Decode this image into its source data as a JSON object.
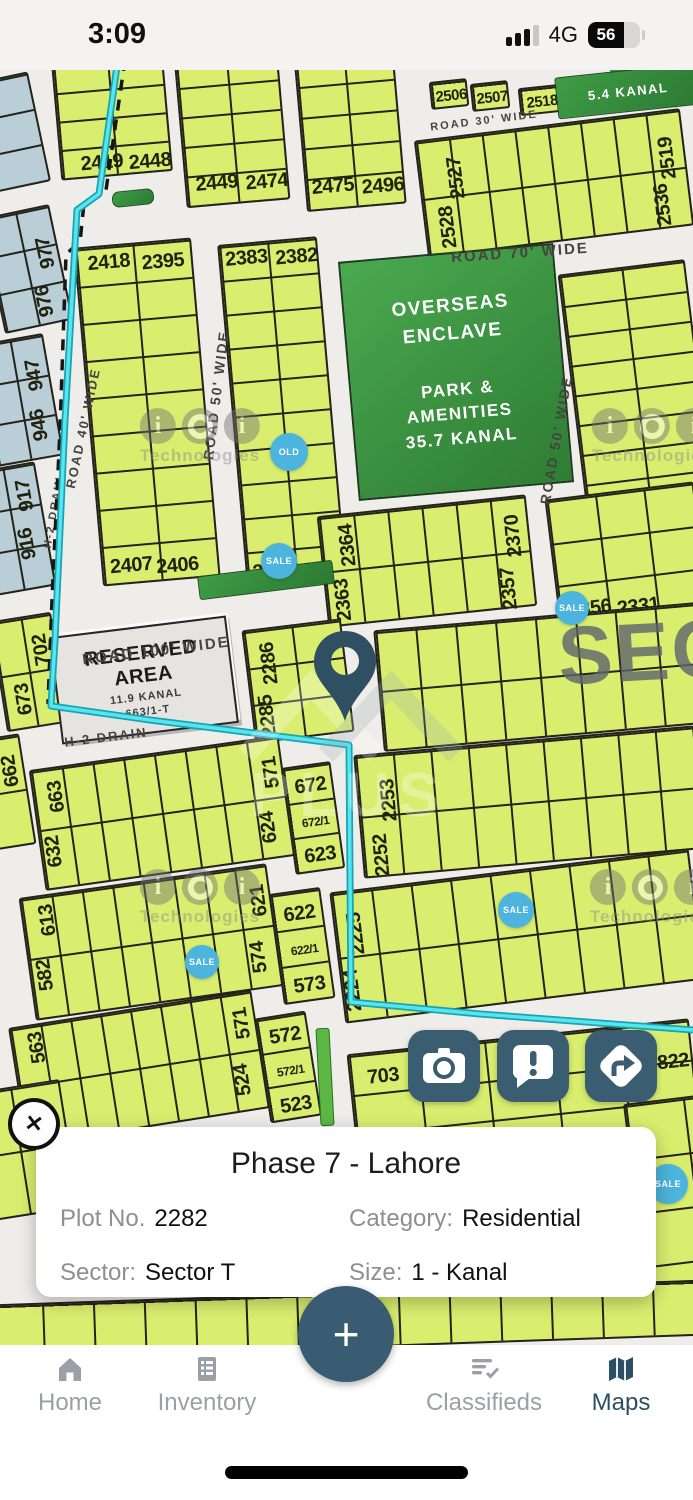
{
  "status_bar": {
    "time": "3:09",
    "network": "4G",
    "battery_percent": "56"
  },
  "map": {
    "colors": {
      "plot_fill": "#d9ee6f",
      "plot_border": "#23231a",
      "blue_plot": "#b9ced6",
      "park_green": "#3d9c43",
      "drain_cyan": "#4fdde7",
      "badge_blue": "#4cb4dd",
      "slate_accent": "#3b5d72"
    },
    "blocks": [
      {
        "x": -16,
        "y": 76,
        "w": 56,
        "h": 112,
        "cols": 1,
        "rows": 3,
        "rot": -12,
        "c": "blue",
        "labels": []
      },
      {
        "x": -8,
        "y": 210,
        "w": 70,
        "h": 118,
        "cols": 2,
        "rows": 3,
        "rot": -12,
        "c": "blue",
        "labels": [
          {
            "t": "977",
            "x": 55,
            "y": 45,
            "v": 1
          },
          {
            "t": "976",
            "x": 44,
            "y": 92,
            "v": 1
          }
        ]
      },
      {
        "x": -14,
        "y": 338,
        "w": 68,
        "h": 124,
        "cols": 2,
        "rows": 3,
        "rot": -10,
        "c": "blue",
        "labels": [
          {
            "t": "947",
            "x": 51,
            "y": 38,
            "v": 1
          },
          {
            "t": "946",
            "x": 47,
            "y": 88,
            "v": 1
          }
        ]
      },
      {
        "x": -20,
        "y": 466,
        "w": 66,
        "h": 126,
        "cols": 2,
        "rows": 3,
        "rot": -10,
        "c": "blue",
        "labels": [
          {
            "t": "917",
            "x": 49,
            "y": 30,
            "v": 1
          },
          {
            "t": "916",
            "x": 43,
            "y": 78,
            "v": 1
          }
        ]
      },
      {
        "x": -2,
        "y": 616,
        "w": 62,
        "h": 112,
        "cols": 2,
        "rows": 2,
        "rot": -9,
        "labels": [
          {
            "t": "702",
            "x": 45,
            "y": 34,
            "v": 1
          },
          {
            "t": "673",
            "x": 20,
            "y": 80,
            "v": 1
          }
        ]
      },
      {
        "x": -16,
        "y": 736,
        "w": 44,
        "h": 112,
        "cols": 1,
        "rows": 2,
        "rot": -9,
        "labels": [
          {
            "t": "662",
            "x": 28,
            "y": 34,
            "v": 1
          }
        ]
      },
      {
        "x": 56,
        "y": 58,
        "w": 112,
        "h": 118,
        "cols": 2,
        "rows": 4,
        "rot": -5,
        "labels": [
          {
            "t": "2419",
            "x": 40,
            "y": 102
          },
          {
            "t": "2448",
            "x": 88,
            "y": 105
          }
        ]
      },
      {
        "x": 180,
        "y": 52,
        "w": 104,
        "h": 152,
        "cols": 2,
        "rows": 5,
        "rot": -5,
        "labels": [
          {
            "t": "2449",
            "x": 30,
            "y": 128
          },
          {
            "t": "2474",
            "x": 80,
            "y": 131
          }
        ]
      },
      {
        "x": 300,
        "y": 50,
        "w": 100,
        "h": 158,
        "cols": 2,
        "rows": 5,
        "rot": -5,
        "labels": [
          {
            "t": "2475",
            "x": 26,
            "y": 133
          },
          {
            "t": "2496",
            "x": 76,
            "y": 137
          }
        ]
      },
      {
        "x": 430,
        "y": 80,
        "w": 38,
        "h": 28,
        "cols": 1,
        "rows": 1,
        "rot": -6,
        "labels": [
          {
            "t": "2506",
            "x": 19,
            "y": 14,
            "s": 15
          }
        ]
      },
      {
        "x": 471,
        "y": 82,
        "w": 38,
        "h": 28,
        "cols": 1,
        "rows": 1,
        "rot": -6,
        "labels": [
          {
            "t": "2507",
            "x": 19,
            "y": 14,
            "s": 15
          }
        ]
      },
      {
        "x": 519,
        "y": 86,
        "w": 42,
        "h": 28,
        "cols": 1,
        "rows": 1,
        "rot": -6,
        "labels": [
          {
            "t": "2518",
            "x": 21,
            "y": 14,
            "s": 15
          }
        ]
      },
      {
        "x": 420,
        "y": 124,
        "w": 268,
        "h": 118,
        "cols": 8,
        "rows": 2,
        "rot": -7,
        "labels": [
          {
            "t": "2527",
            "x": 36,
            "y": 40,
            "v": 1
          },
          {
            "t": "2528",
            "x": 22,
            "y": 88,
            "v": 1
          },
          {
            "t": "2519",
            "x": 248,
            "y": 46,
            "v": 1
          },
          {
            "t": "2536",
            "x": 238,
            "y": 92,
            "v": 1
          }
        ]
      },
      {
        "x": 88,
        "y": 242,
        "w": 118,
        "h": 340,
        "cols": 2,
        "rows": 9,
        "rot": -5,
        "labels": [
          {
            "t": "2418",
            "x": 32,
            "y": 16
          },
          {
            "t": "2395",
            "x": 86,
            "y": 20
          },
          {
            "t": "2407",
            "x": 28,
            "y": 320
          },
          {
            "t": "2406",
            "x": 74,
            "y": 324
          }
        ]
      },
      {
        "x": 232,
        "y": 240,
        "w": 100,
        "h": 345,
        "cols": 2,
        "rows": 10,
        "rot": -5,
        "labels": [
          {
            "t": "2383",
            "x": 26,
            "y": 14
          },
          {
            "t": "2382",
            "x": 76,
            "y": 17
          },
          {
            "t": "2394",
            "x": 26,
            "y": 328
          },
          {
            "t": "2381",
            "x": 76,
            "y": 331
          }
        ]
      },
      {
        "x": 572,
        "y": 266,
        "w": 128,
        "h": 244,
        "cols": 2,
        "rows": 8,
        "rot": -7,
        "labels": []
      },
      {
        "x": 322,
        "y": 505,
        "w": 210,
        "h": 112,
        "cols": 6,
        "rows": 2,
        "rot": -6,
        "labels": [
          {
            "t": "2364",
            "x": 26,
            "y": 30,
            "v": 1
          },
          {
            "t": "2363",
            "x": 16,
            "y": 84,
            "v": 1
          },
          {
            "t": "2370",
            "x": 192,
            "y": 38,
            "v": 1
          },
          {
            "t": "2357",
            "x": 182,
            "y": 90,
            "v": 1
          }
        ]
      },
      {
        "x": 552,
        "y": 490,
        "w": 150,
        "h": 132,
        "cols": 3,
        "rows": 3,
        "rot": -7,
        "labels": [
          {
            "t": "2356",
            "x": 30,
            "y": 112
          },
          {
            "t": "2331",
            "x": 78,
            "y": 116
          }
        ]
      },
      {
        "x": 248,
        "y": 624,
        "w": 100,
        "h": 114,
        "cols": 2,
        "rows": 3,
        "rot": -7,
        "labels": [
          {
            "t": "2286",
            "x": 22,
            "y": 34,
            "v": 1
          },
          {
            "t": "2285",
            "x": 14,
            "y": 86,
            "v": 1
          }
        ]
      },
      {
        "x": 378,
        "y": 616,
        "w": 324,
        "h": 122,
        "cols": 8,
        "rows": 2,
        "rot": -5,
        "labels": []
      },
      {
        "x": 36,
        "y": 752,
        "w": 252,
        "h": 122,
        "cols": 8,
        "rows": 2,
        "rot": -8,
        "labels": [
          {
            "t": "663",
            "x": 22,
            "y": 28,
            "v": 1
          },
          {
            "t": "632",
            "x": 12,
            "y": 82,
            "v": 1
          },
          {
            "t": "571",
            "x": 238,
            "y": 34,
            "v": 1
          },
          {
            "t": "624",
            "x": 228,
            "y": 88,
            "v": 1
          }
        ]
      },
      {
        "x": 288,
        "y": 764,
        "w": 50,
        "h": 108,
        "cols": 1,
        "rows": 3,
        "rot": -8,
        "labels": [
          {
            "t": "672",
            "x": 25,
            "y": 20
          },
          {
            "t": "672/1",
            "x": 25,
            "y": 56,
            "s": 12
          },
          {
            "t": "623",
            "x": 25,
            "y": 90
          }
        ]
      },
      {
        "x": 26,
        "y": 880,
        "w": 250,
        "h": 124,
        "cols": 8,
        "rows": 2,
        "rot": -8,
        "labels": [
          {
            "t": "613",
            "x": 24,
            "y": 24,
            "v": 1
          },
          {
            "t": "582",
            "x": 14,
            "y": 78,
            "v": 1
          },
          {
            "t": "621",
            "x": 236,
            "y": 34,
            "v": 1
          },
          {
            "t": "574",
            "x": 228,
            "y": 90,
            "v": 1
          }
        ]
      },
      {
        "x": 276,
        "y": 890,
        "w": 52,
        "h": 112,
        "cols": 1,
        "rows": 3,
        "rot": -8,
        "labels": [
          {
            "t": "622",
            "x": 26,
            "y": 22
          },
          {
            "t": "622/1",
            "x": 26,
            "y": 58,
            "s": 12
          },
          {
            "t": "573",
            "x": 26,
            "y": 94
          }
        ]
      },
      {
        "x": 16,
        "y": 1008,
        "w": 246,
        "h": 120,
        "cols": 8,
        "rows": 2,
        "rot": -9,
        "labels": [
          {
            "t": "563",
            "x": 24,
            "y": 22,
            "v": 1
          },
          {
            "t": "532",
            "x": 12,
            "y": 76,
            "v": 1
          },
          {
            "t": "571",
            "x": 230,
            "y": 30,
            "v": 1
          },
          {
            "t": "524",
            "x": 222,
            "y": 86,
            "v": 1
          }
        ]
      },
      {
        "x": 262,
        "y": 1014,
        "w": 52,
        "h": 106,
        "cols": 1,
        "rows": 3,
        "rot": -9,
        "labels": [
          {
            "t": "572",
            "x": 26,
            "y": 20
          },
          {
            "t": "572/1",
            "x": 26,
            "y": 55,
            "s": 12
          },
          {
            "t": "523",
            "x": 26,
            "y": 90
          }
        ]
      },
      {
        "x": 352,
        "y": 1036,
        "w": 344,
        "h": 122,
        "cols": 5,
        "rows": 3,
        "rot": -6,
        "labels": [
          {
            "t": "703",
            "x": 32,
            "y": 24
          },
          {
            "t": "822",
            "x": 322,
            "y": 40
          }
        ]
      },
      {
        "x": 358,
        "y": 740,
        "w": 342,
        "h": 124,
        "cols": 9,
        "rows": 2,
        "rot": -5,
        "labels": [
          {
            "t": "2253",
            "x": 30,
            "y": 46,
            "v": 1
          },
          {
            "t": "2252",
            "x": 18,
            "y": 100,
            "v": 1
          }
        ]
      },
      {
        "x": 336,
        "y": 870,
        "w": 362,
        "h": 132,
        "cols": 9,
        "rows": 2,
        "rot": -7,
        "labels": [
          {
            "t": "2225",
            "x": 20,
            "y": 42,
            "v": 1
          },
          {
            "t": "2224",
            "x": 10,
            "y": 98,
            "v": 1
          }
        ]
      },
      {
        "x": -30,
        "y": 1086,
        "w": 100,
        "h": 130,
        "cols": 2,
        "rows": 2,
        "rot": -9,
        "labels": []
      },
      {
        "x": 636,
        "y": 1096,
        "w": 120,
        "h": 220,
        "cols": 2,
        "rows": 4,
        "rot": -7,
        "labels": []
      },
      {
        "x": -10,
        "y": 1292,
        "w": 716,
        "h": 56,
        "cols": 14,
        "rows": 1,
        "rot": -2,
        "labels": []
      }
    ],
    "park": {
      "x": 348,
      "y": 252,
      "w": 212,
      "h": 236,
      "rot": -5,
      "lines": [
        "OVERSEAS ENCLAVE",
        "PARK &",
        "AMENITIES",
        "35.7  KANAL"
      ]
    },
    "reserved": {
      "x": 55,
      "y": 626,
      "w": 174,
      "h": 104,
      "rot": -7,
      "lines": [
        "RESERVED AREA",
        "11.9  KANAL",
        "663/1-T"
      ]
    },
    "accents": [
      {
        "x": 112,
        "y": 190,
        "w": 40,
        "h": 14,
        "rot": -6,
        "r": 7
      },
      {
        "x": 198,
        "y": 568,
        "w": 134,
        "h": 22,
        "rot": -7
      },
      {
        "x": 610,
        "y": 58,
        "w": 90,
        "h": 12,
        "rot": -6
      },
      {
        "x": 556,
        "y": 70,
        "w": 142,
        "h": 40,
        "rot": -6,
        "label": "5.4 KANAL"
      },
      {
        "x": 318,
        "y": 1028,
        "w": 12,
        "h": 96,
        "rot": -3,
        "c": "bright"
      }
    ],
    "road_labels": [
      {
        "t": "ROAD 30' WIDE",
        "x": 484,
        "y": 121,
        "rot": -7,
        "s": 11
      },
      {
        "t": "ROAD 70' WIDE",
        "x": 520,
        "y": 253,
        "rot": -4,
        "s": 15
      },
      {
        "t": "ROAD 50' WIDE",
        "x": 216,
        "y": 395,
        "rot": -83,
        "s": 14
      },
      {
        "t": "ROAD 50' WIDE",
        "x": 556,
        "y": 440,
        "rot": -80,
        "s": 14
      },
      {
        "t": "ROAD 40' WIDE",
        "x": 83,
        "y": 428,
        "rot": -78,
        "s": 13
      },
      {
        "t": "ROAD 100' WIDE",
        "x": 156,
        "y": 651,
        "rot": -7,
        "s": 15
      },
      {
        "t": "H-2 DRAIN",
        "x": 54,
        "y": 512,
        "rot": -80,
        "s": 11
      },
      {
        "t": "H-2 DRAIN",
        "x": 106,
        "y": 737,
        "rot": -7,
        "s": 13
      }
    ],
    "sector_overlay": "SEC",
    "badges": [
      {
        "t": "OLD",
        "x": 289,
        "y": 452,
        "d": 38
      },
      {
        "t": "SALE",
        "x": 279,
        "y": 561,
        "d": 36
      },
      {
        "t": "SALE",
        "x": 572,
        "y": 608,
        "d": 34
      },
      {
        "t": "SALE",
        "x": 516,
        "y": 910,
        "d": 36
      },
      {
        "t": "SALE",
        "x": 202,
        "y": 962,
        "d": 34
      },
      {
        "t": "SALE",
        "x": 668,
        "y": 1184,
        "d": 40
      }
    ],
    "watermark_brand": "Technologies",
    "center_watermark": "PLUS",
    "watermarks": [
      {
        "x": 200,
        "y": 437
      },
      {
        "x": 652,
        "y": 437
      },
      {
        "x": 200,
        "y": 898
      },
      {
        "x": 650,
        "y": 898
      }
    ]
  },
  "action_buttons": [
    {
      "name": "camera"
    },
    {
      "name": "report"
    },
    {
      "name": "directions"
    }
  ],
  "plot_card": {
    "title": "Phase 7 - Lahore",
    "fields": [
      {
        "label": "Plot No.",
        "value": "2282"
      },
      {
        "label": "Category:",
        "value": "Residential"
      },
      {
        "label": "Sector:",
        "value": "Sector T"
      },
      {
        "label": "Size:",
        "value": "1 - Kanal"
      }
    ]
  },
  "fab": {
    "label": "+"
  },
  "bottom_nav": {
    "active": "Maps",
    "items": [
      {
        "label": "Home"
      },
      {
        "label": "Inventory"
      },
      {
        "label": "Classifieds"
      },
      {
        "label": "Maps"
      }
    ]
  }
}
